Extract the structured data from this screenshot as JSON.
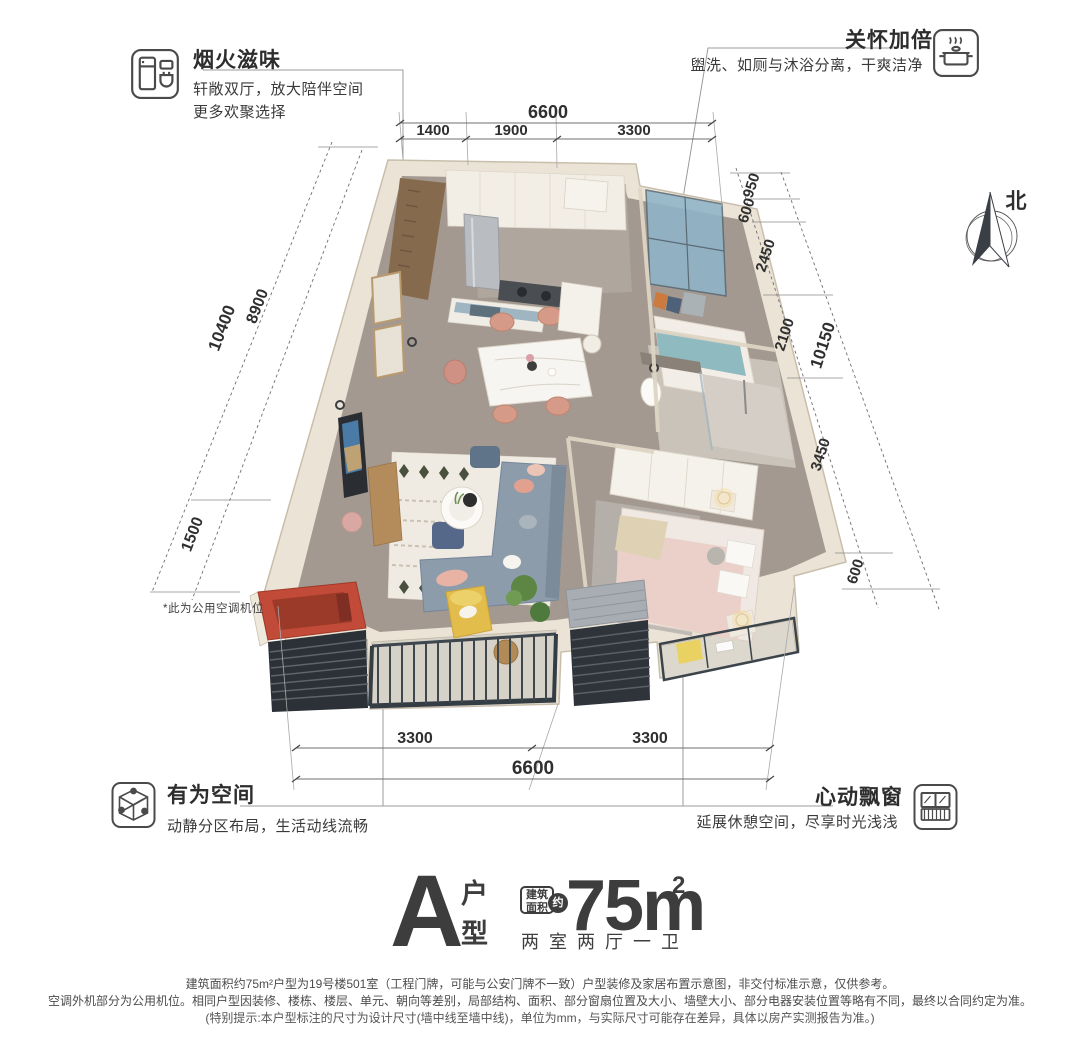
{
  "features": {
    "yanhuo": {
      "title": "烟火滋味",
      "desc1": "轩敞双厅，放大陪伴空间",
      "desc2": "更多欢聚选择"
    },
    "guanhuai": {
      "title": "关怀加倍",
      "desc": "盥洗、如厕与沐浴分离，干爽洁净"
    },
    "youwei": {
      "title": "有为空间",
      "desc": "动静分区布局，生活动线流畅"
    },
    "xindong": {
      "title": "心动飘窗",
      "desc": "延展休憩空间，尽享时光浅浅"
    }
  },
  "north": {
    "label": "北"
  },
  "plan_note": "*此为公用空调机位",
  "dims": {
    "top": {
      "total": "6600",
      "seg1": "1400",
      "seg2": "1900",
      "seg3": "3300"
    },
    "left": {
      "total": "10400",
      "seg1": "8900",
      "seg2": "1500"
    },
    "right": {
      "total": "10150",
      "seg1": "950",
      "seg2": "600",
      "seg3": "2450",
      "seg4": "2100",
      "seg5": "3450",
      "seg6": "600"
    },
    "bottom": {
      "total": "6600",
      "seg1": "3300",
      "seg2": "3300"
    }
  },
  "title_block": {
    "letter": "A",
    "char1": "户",
    "char2": "型",
    "badge1": "建筑",
    "badge2": "面积",
    "badge_circle": "约",
    "area": "75m",
    "sup": "2",
    "rooms": "两室两厅一卫"
  },
  "disclaimer": {
    "line1": "建筑面积约75m²户型为19号楼501室（工程门牌，可能与公安门牌不一致）户型装修及家居布置示意图，非交付标准示意，仅供参考。",
    "line2": "空调外机部分为公用机位。相同户型因装修、楼栋、楼层、单元、朝向等差别，局部结构、面积、部分窗扇位置及大小、墙壁大小、部分电器安装位置等略有不同，最终以合同约定为准。",
    "line3": "(特别提示:本户型标注的尺寸为设计尺寸(墙中线至墙中线)，单位为mm，与实际尺寸可能存在差异，具体以房产实测报告为准。)"
  },
  "colors": {
    "accent_red": "#c24a38",
    "wall": "#ebe4d6",
    "railing": "#3b434b",
    "glass": "#8fb4c8"
  }
}
